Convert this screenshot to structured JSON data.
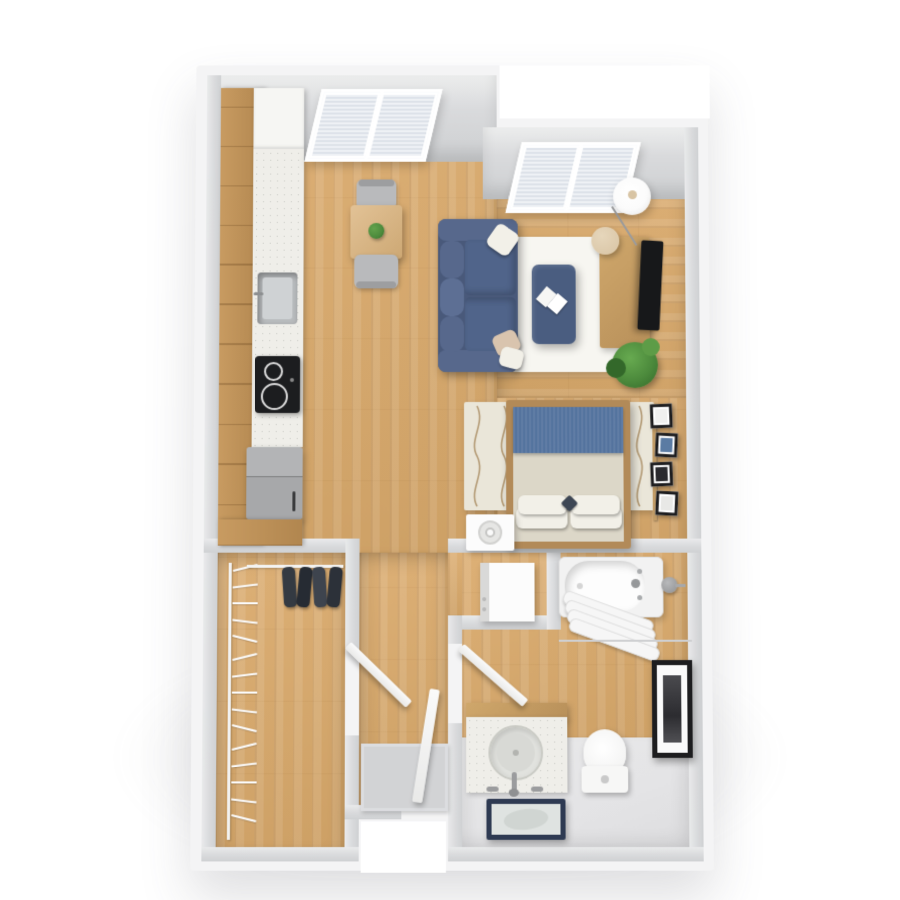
{
  "scene": {
    "title": "3D rendered top-down floor plan of a studio apartment",
    "render_style": "photoreal 3D dollhouse view, no text labels",
    "background": "#ffffff"
  },
  "palette": {
    "wall_gray": "#d9dadc",
    "wall_gray_dark": "#cfd1d3",
    "wall_outer": "#f4f4f5",
    "floor_wood": "#ddb076",
    "floor_wood_dark": "#cda065",
    "tile_gray": "#e4e4e6",
    "rug_white": "#f7f6f1",
    "rug_cream": "#eae6d9",
    "rug_wave": "#a98c62",
    "sofa_blue": "#49597a",
    "sofa_blue_light": "#57688c",
    "sofa_seat": "#50648a",
    "ottoman_blue": "#4a5d80",
    "pillow_white": "#f2f0e8",
    "pillow_beige": "#d9c4ae",
    "bed_frame": "#b28a58",
    "bed_blanket": "#54739e",
    "bed_sheet": "#dcd7c8",
    "accent_pillow": "#3d4654",
    "wood_furniture": "#c49e68",
    "counter": "#efeee9",
    "sink_gray": "#b9bcbe",
    "cooktop_black": "#1c1d1f",
    "appliance_gray": "#a7a8aa",
    "tv_black": "#17181a",
    "plant_green": "#4c8a3c",
    "plant_dark": "#33682a",
    "lamp_white": "#fbfbfb",
    "lamp_base": "#d8c4a4",
    "mat_gray": "#d2d3d5",
    "mirror_navy": "#2e3a52",
    "frame_black": "#1d1d1f",
    "towel_white": "#f6f6f6",
    "door_white": "#f4f4f3",
    "clothes_dark": "#343a42"
  },
  "rooms": [
    {
      "id": "kitchen",
      "label": "kitchen",
      "items": [
        "upper-cabinets",
        "counter-run",
        "sink",
        "cooktop",
        "refrigerator",
        "base-cabinet"
      ]
    },
    {
      "id": "dining-area",
      "label": "dining area",
      "items": [
        "dining-table",
        "table-plant",
        "chair-north",
        "chair-south"
      ]
    },
    {
      "id": "living-area",
      "label": "living area",
      "items": [
        "sofa",
        "throw-pillows",
        "area-rug",
        "ottoman",
        "open-book",
        "tv-stand",
        "tv",
        "floor-lamp",
        "side-table",
        "potted-plant",
        "window"
      ]
    },
    {
      "id": "sleeping-area",
      "label": "sleeping area",
      "items": [
        "double-bed",
        "blue-blanket",
        "pillows",
        "patterned-rug",
        "nightstand-speaker",
        "photo-ledge"
      ]
    },
    {
      "id": "laundry-niche",
      "label": "storage niche",
      "items": [
        "white-appliance-box"
      ]
    },
    {
      "id": "bathroom",
      "label": "bathroom",
      "items": [
        "bathtub",
        "tub-faucet",
        "towel-rail",
        "towels",
        "wall-knob",
        "vanity-sink",
        "toilet",
        "leaning-mirror",
        "wall-art",
        "door"
      ]
    },
    {
      "id": "hallway",
      "label": "entry hall",
      "items": [
        "doormat",
        "entry-door",
        "closet-door",
        "bathroom-door"
      ]
    },
    {
      "id": "closet",
      "label": "walk-in closet",
      "items": [
        "west-hanger-rail",
        "hangers",
        "north-clothes-rail",
        "hanging-clothes"
      ]
    }
  ],
  "closet": {
    "hangers": 15,
    "hanging_clothes": [
      "#343a42",
      "#262b33",
      "#3e444e",
      "#2c3139"
    ]
  },
  "bathroom": {
    "towel_bars": 4
  },
  "sleeping_area": {
    "rug_wave_lines": 7,
    "photo_frames": [
      "#f0f0ef",
      "#5b7ba3",
      "#2a2a2e",
      "#e8e8e6"
    ]
  },
  "windows": {
    "kitchen_panels": 2,
    "living_panels": 2,
    "blind_sections_per_panel": 2
  }
}
